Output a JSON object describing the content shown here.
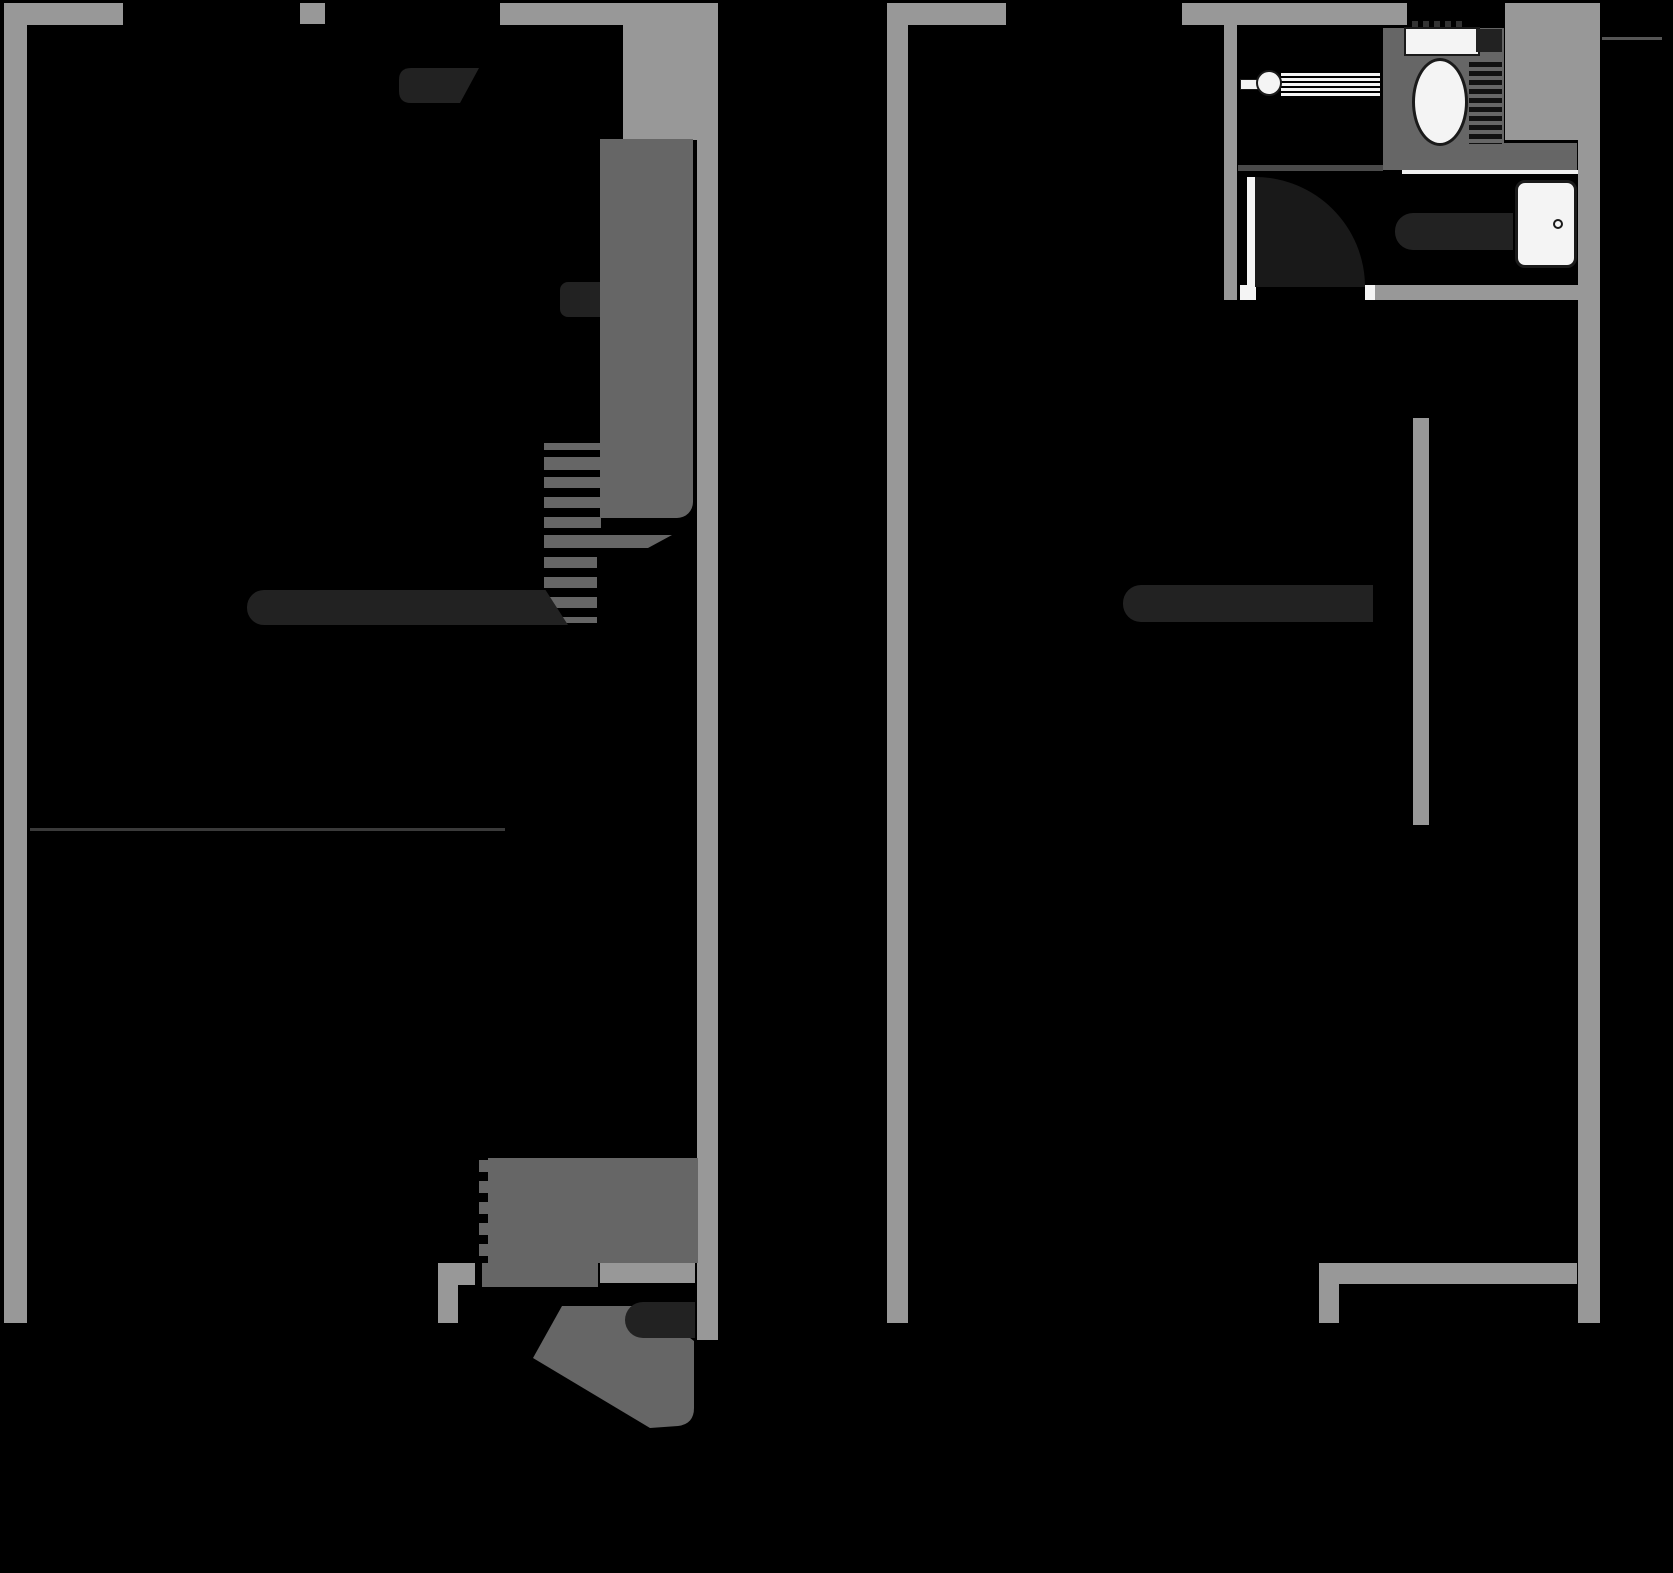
{
  "meta": {
    "type": "architectural-floor-plan",
    "floors_shown": 2,
    "text_labels": []
  },
  "colors": {
    "bg": "#000000",
    "wall": "#989898",
    "unit": "#666666",
    "dark": "#222222",
    "fixture": "#f4f4f4",
    "fixture_border": "#1a1a1a",
    "swing": "#191919",
    "divider": "#4a4a4a",
    "white_line": "#f0f0f0",
    "faint": "#3a3a3a",
    "thin": "#555555",
    "hatch": "#333333",
    "stripe": "#111111"
  },
  "plans": {
    "left_unit": {
      "elements": [
        "outer-walls",
        "window-openings",
        "wardrobe-block",
        "staircase",
        "stair-handrail",
        "wall-cabinet-handle",
        "corner-furniture",
        "kitchen-unit-with-radiator",
        "entrance-threshold",
        "open-entrance-door",
        "door-side-radiator",
        "faint-floor-line"
      ]
    },
    "right_unit": {
      "elements": [
        "outer-walls",
        "window-openings",
        "bathroom",
        "shower-head-with-spray",
        "toilet",
        "toilet-cistern",
        "wash-basin",
        "bathroom-door-with-swing",
        "towel-radiator",
        "partition-wall",
        "wall-radiator"
      ]
    }
  }
}
